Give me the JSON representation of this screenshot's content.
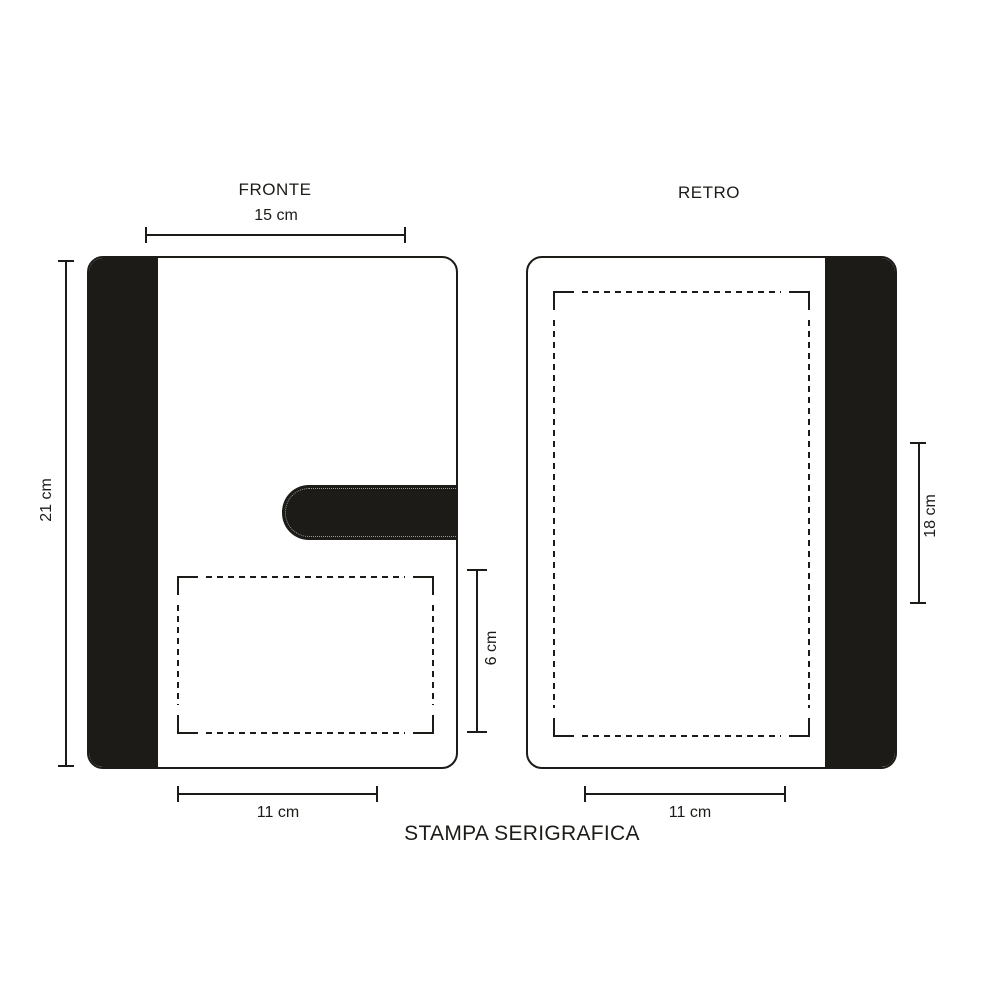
{
  "colors": {
    "ink": "#1d1b17",
    "paper": "#ffffff"
  },
  "front_view": {
    "label": "FRONTE",
    "cover_width": "15 cm",
    "cover_height": "21 cm",
    "print_area_height": "6 cm",
    "print_area_width": "11 cm"
  },
  "back_view": {
    "label": "RETRO",
    "print_area_height": "18 cm",
    "print_area_width": "11 cm"
  },
  "footer": {
    "technique": "STAMPA SERIGRAFICA"
  }
}
